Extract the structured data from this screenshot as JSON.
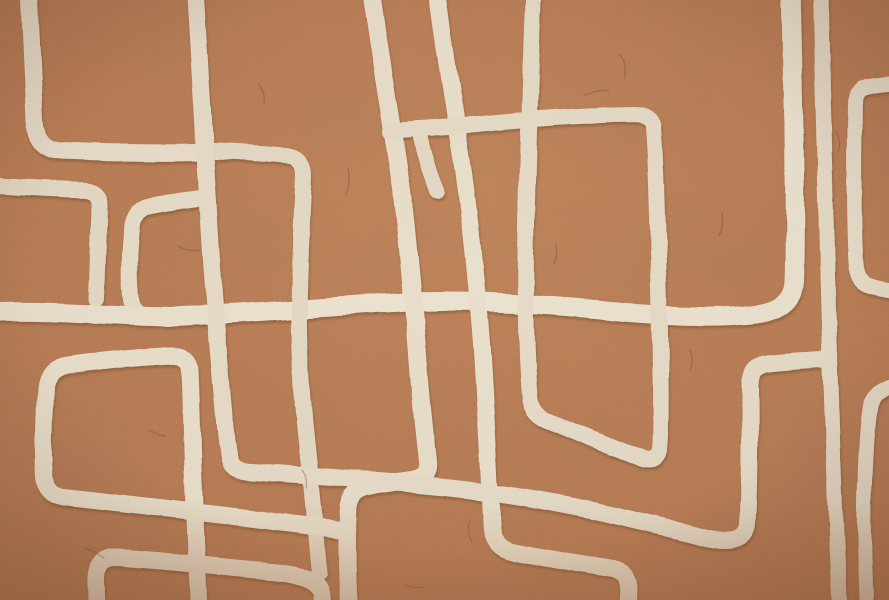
{
  "artwork": {
    "kind": "abstract-terracotta-line-art",
    "canvas": {
      "width": 889,
      "height": 600
    },
    "palette": {
      "background": "#b87a52",
      "background_light": "#cf9162",
      "background_dark": "#a76b46",
      "line_cream": "#e7ddc9",
      "stroke_shadow": "#5f3a1f",
      "crack": "#6b4226",
      "vignette": "#4a2612"
    },
    "strokes": [
      {
        "name": "corner-top-left",
        "width": 17,
        "color": "#e7ddc9",
        "path": "M 29,-12 C 31,40 33,85 35,120 Q 37,148 60,150 C 105,152 155,153 201,152"
      },
      {
        "name": "band-left",
        "width": 16,
        "color": "#e3d9c5",
        "path": "M -12,185 C 25,187 55,189 86,190 Q 100,192 99,207 C 98,235 97,268 96,298"
      },
      {
        "name": "small-rect-left",
        "width": 16,
        "color": "#e6dcc8",
        "path": "M 202,198 C 185,200 165,203 150,206 Q 136,209 132,225 C 129,250 128,276 131,299 Q 133,311 142,315"
      },
      {
        "name": "horizontal-main",
        "width": 19,
        "color": "#eae1cf",
        "path": "M -12,312 C 50,309 110,316 170,317 C 250,314 330,306 410,302 C 470,300 540,304 610,311 C 660,316 710,319 756,314 Q 792,309 794,282 C 796,225 794,110 791,-12"
      },
      {
        "name": "vertical-center-left",
        "width": 16,
        "color": "#e2d8c4",
        "path": "M 204,151 C 232,152 262,154 286,156 Q 304,158 304,176 C 302,220 300,262 299,308 C 298,360 304,420 309,466 C 312,498 316,544 319,572"
      },
      {
        "name": "slanted-vertical-left",
        "width": 18,
        "color": "#e7ddc9",
        "path": "M 370,-12 C 378,50 391,120 400,180 C 407,230 413,300 418,368 C 421,408 425,442 427,461 Q 429,477 411,480 C 398,482 381,484 369,487 Q 352,490 349,507 C 347,542 348,577 350,612"
      },
      {
        "name": "tall-diagonal-center",
        "width": 17,
        "color": "#e8dfcb",
        "path": "M 436,-12 C 444,50 455,115 463,165 C 470,215 477,285 482,350 C 486,420 490,480 491,523 Q 491,547 511,552 C 546,559 584,565 614,570 Q 628,573 629,587 L 628,612"
      },
      {
        "name": "drop-junction",
        "width": 15,
        "color": "#e2d8c4",
        "path": "M 420,137 C 424,155 430,175 437,192"
      },
      {
        "name": "hook-loop",
        "width": 16,
        "color": "#e4dac6",
        "path": "M 534,-12 C 531,70 527,170 526,255 C 525,320 527,372 530,400 Q 533,415 549,421 C 576,432 614,448 641,458 Q 659,464 660,445 C 662,385 659,275 656,185 C 655,160 654,140 653,127 Q 652,115 634,114 C 575,115 500,121 448,127 L 390,131"
      },
      {
        "name": "long-vertical-diagonal",
        "width": 17,
        "color": "#e5dbc7",
        "path": "M 195,-12 C 199,60 204,140 209,220 C 213,290 219,360 224,418 C 226,440 228,455 230,462 Q 233,471 251,472 C 330,477 420,483 494,493 C 560,502 638,520 700,536 Q 746,548 748,524 C 751,470 750,420 750,385 Q 751,366 769,364 C 786,362 806,361 823,360"
      },
      {
        "name": "bracket-right",
        "width": 15,
        "color": "#e6dcc8",
        "path": "M 901,82 C 888,83 875,84 866,86 Q 855,88 855,103 C 854,150 853,218 856,263 Q 857,281 869,285 C 878,288 890,290 901,291"
      },
      {
        "name": "vertical-right",
        "width": 15,
        "color": "#e3d9c5",
        "path": "M 820,-12 C 822,80 825,175 827,255 C 829,340 833,440 836,520 C 838,560 839,590 840,612"
      },
      {
        "name": "vertical-far-right",
        "width": 14,
        "color": "#e5dbc7",
        "path": "M 901,384 Q 877,388 871,402 C 866,432 863,500 865,558 L 867,612"
      },
      {
        "name": "rect-left",
        "width": 17,
        "color": "#e8dfcb",
        "path": "M 199,612 C 197,560 195,510 193,470 C 192,430 191,392 190,370 Q 189,355 171,356 C 135,358 96,362 66,366 Q 48,369 46,387 C 44,418 43,452 45,477 Q 46,494 63,497 C 112,503 170,509 230,516 C 270,521 310,526 344,531"
      },
      {
        "name": "rect-bottom-left",
        "width": 17,
        "color": "#e7ddc9",
        "path": "M 97,612 L 96,582 Q 95,556 117,557 C 162,560 222,566 282,572 Q 320,577 322,595 L 323,612"
      }
    ],
    "cracks": [
      {
        "path": "M 348,168 q 3,14 -2,26"
      },
      {
        "path": "M 620,55 q 8,10 4,24"
      },
      {
        "path": "M 178,246 q 10,6 22,4"
      },
      {
        "path": "M 722,214 q 2,12 -3,22"
      },
      {
        "path": "M 84,548 q 12,4 20,10"
      },
      {
        "path": "M 470,520 q -4,12 2,22"
      },
      {
        "path": "M 836,132 q 6,10 2,20"
      },
      {
        "path": "M 258,84 q 8,8 6,20"
      },
      {
        "path": "M 556,244 q 2,10 -2,20"
      },
      {
        "path": "M 150,430 q 8,6 16,6"
      },
      {
        "path": "M 690,350 q 4,10 0,20"
      },
      {
        "path": "M 405,585 q 10,4 18,2"
      },
      {
        "path": "M 585,95 q 14,-6 24,-4"
      },
      {
        "path": "M 302,470 q 6,8 4,18"
      }
    ]
  }
}
